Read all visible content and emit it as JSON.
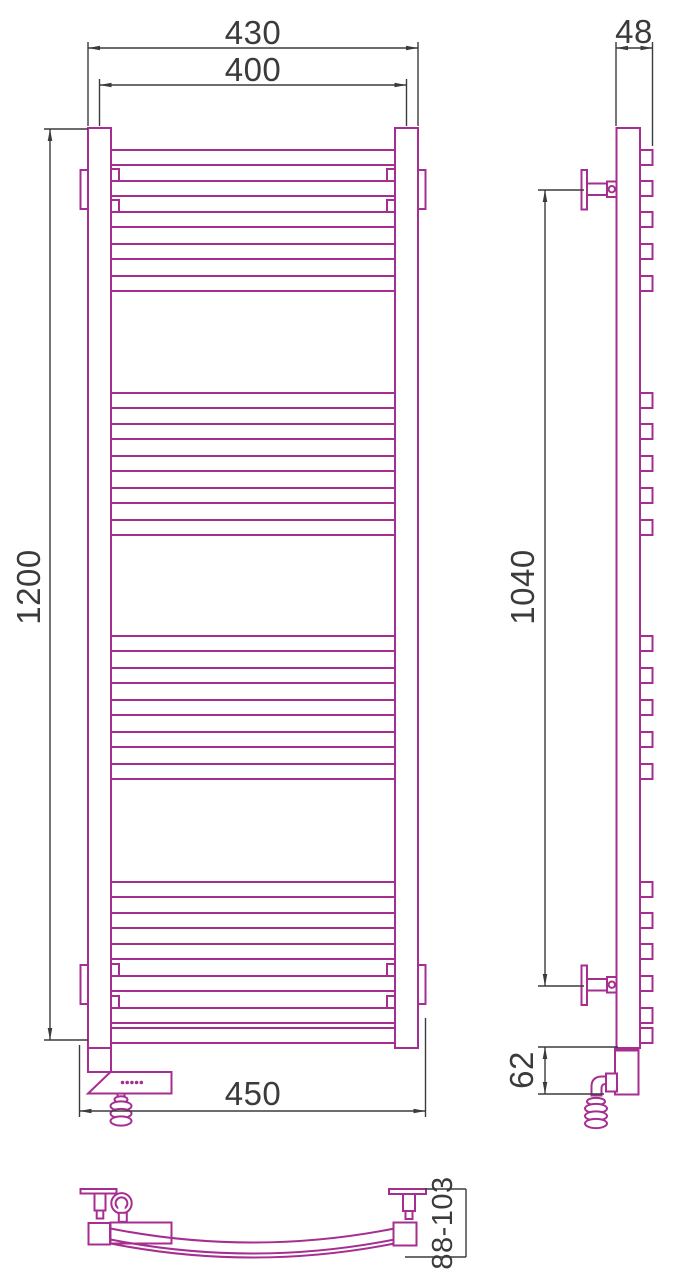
{
  "drawing": {
    "colors": {
      "product_outline": "#a62e90",
      "dimension": "#3b3b3b",
      "background": "#ffffff"
    },
    "dimensions": {
      "overall_width": "430",
      "rail_centers_width": "400",
      "overall_height": "1200",
      "overall_width_with_brackets": "450",
      "depth": "48",
      "bracket_vertical_distance": "1040",
      "bottom_section_height": "62",
      "wall_clearance_range": "88-103"
    },
    "front_view": {
      "rung_rows": [
        150,
        181,
        212,
        244,
        276,
        393,
        424,
        456,
        488,
        520,
        636,
        668,
        700,
        732,
        764,
        882,
        913,
        944,
        976,
        1008,
        1028
      ],
      "rung_height": 15
    }
  }
}
